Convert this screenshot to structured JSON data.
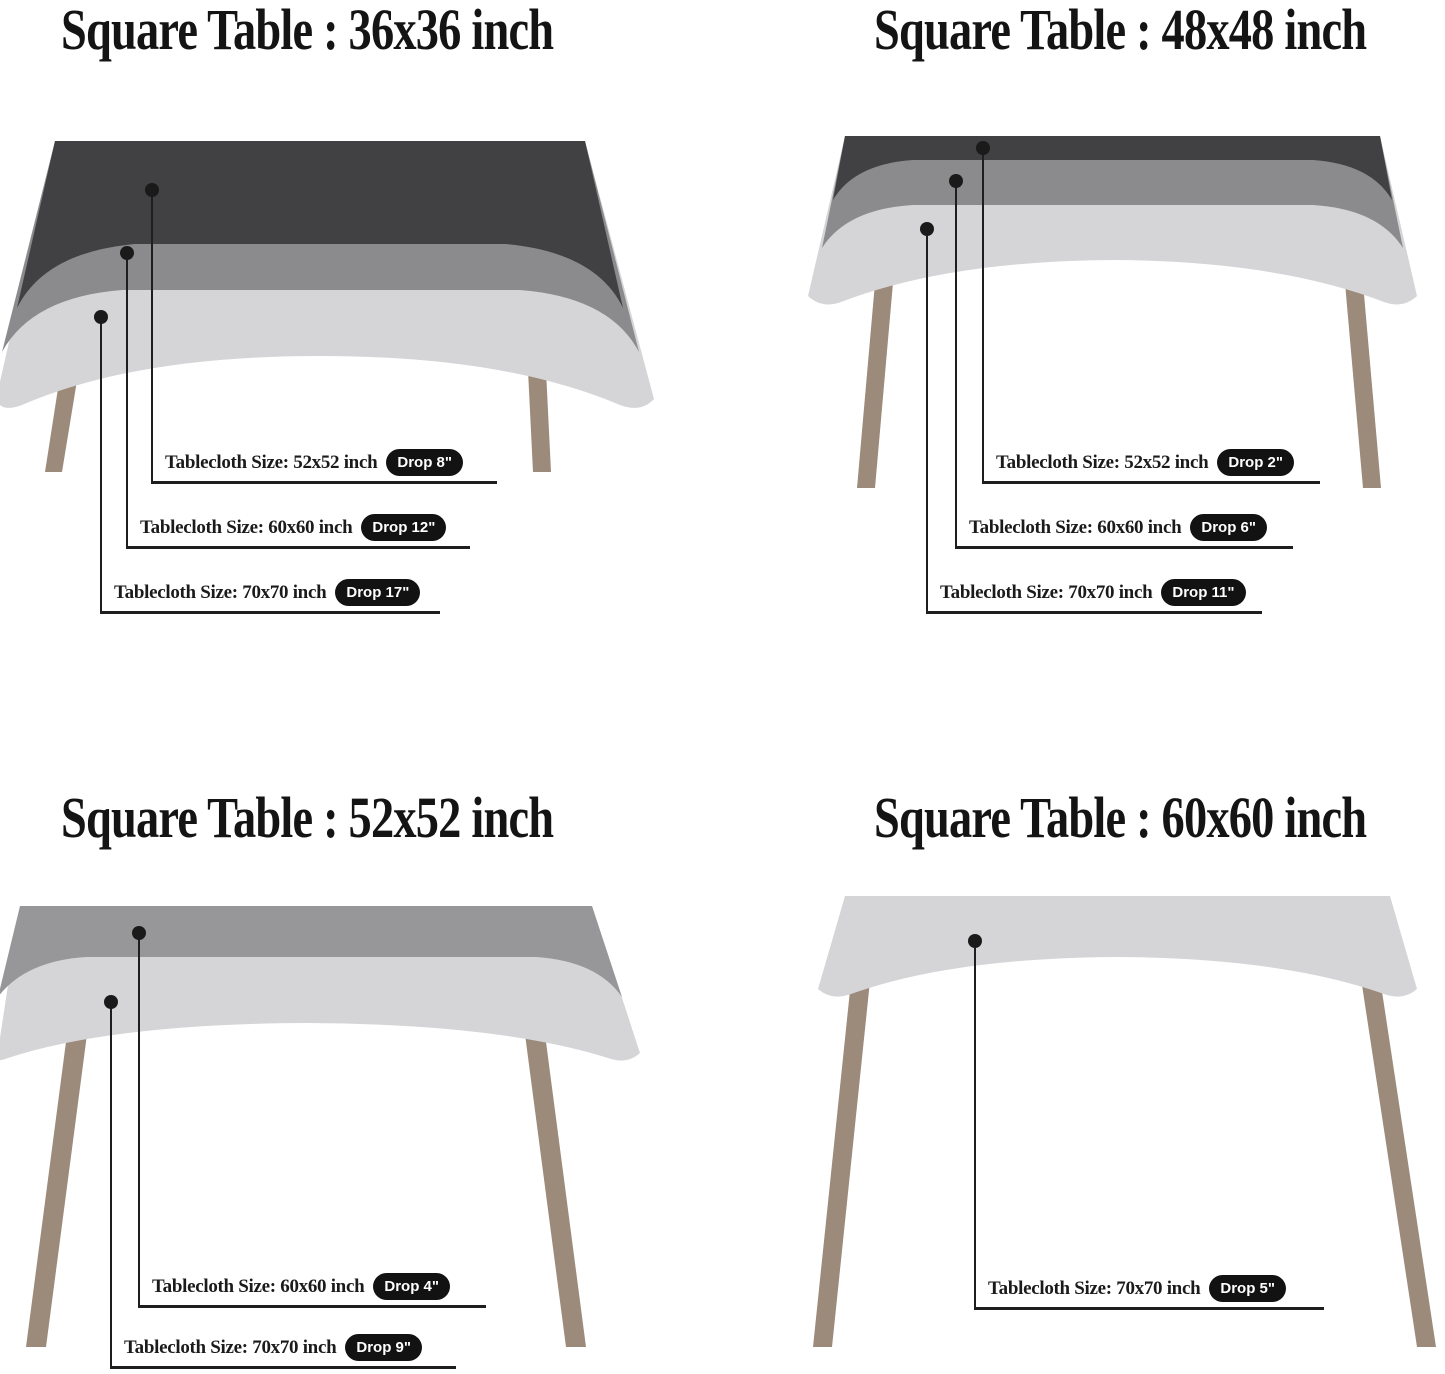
{
  "page": {
    "background": "#ffffff",
    "description": "Tablecloth size guide for square tables"
  },
  "palette": {
    "cloth_dark": "#414144",
    "cloth_medium": "#8b8b8e",
    "cloth_light": "#d5d5d7",
    "table_leg": "#9c8a7a",
    "callout_line": "#1e1e1e",
    "badge_background": "#121212",
    "badge_text": "#ffffff",
    "title_text": "#141414"
  },
  "quadrants": [
    {
      "title": "Square Table : 36x36 inch",
      "callouts": [
        {
          "label": "Tablecloth Size: 52x52 inch",
          "badge": "Drop 8\""
        },
        {
          "label": "Tablecloth Size: 60x60 inch",
          "badge": "Drop 12\""
        },
        {
          "label": "Tablecloth Size: 70x70 inch",
          "badge": "Drop 17\""
        }
      ]
    },
    {
      "title": "Square Table : 48x48 inch",
      "callouts": [
        {
          "label": "Tablecloth Size: 52x52 inch",
          "badge": "Drop 2\""
        },
        {
          "label": "Tablecloth Size: 60x60 inch",
          "badge": "Drop 6\""
        },
        {
          "label": "Tablecloth Size: 70x70 inch",
          "badge": "Drop 11\""
        }
      ]
    },
    {
      "title": "Square Table : 52x52 inch",
      "callouts": [
        {
          "label": "Tablecloth Size: 60x60 inch",
          "badge": "Drop 4\""
        },
        {
          "label": "Tablecloth Size: 70x70 inch",
          "badge": "Drop 9\""
        }
      ]
    },
    {
      "title": "Square Table : 60x60 inch",
      "callouts": [
        {
          "label": "Tablecloth Size: 70x70 inch",
          "badge": "Drop 5\""
        }
      ]
    }
  ]
}
